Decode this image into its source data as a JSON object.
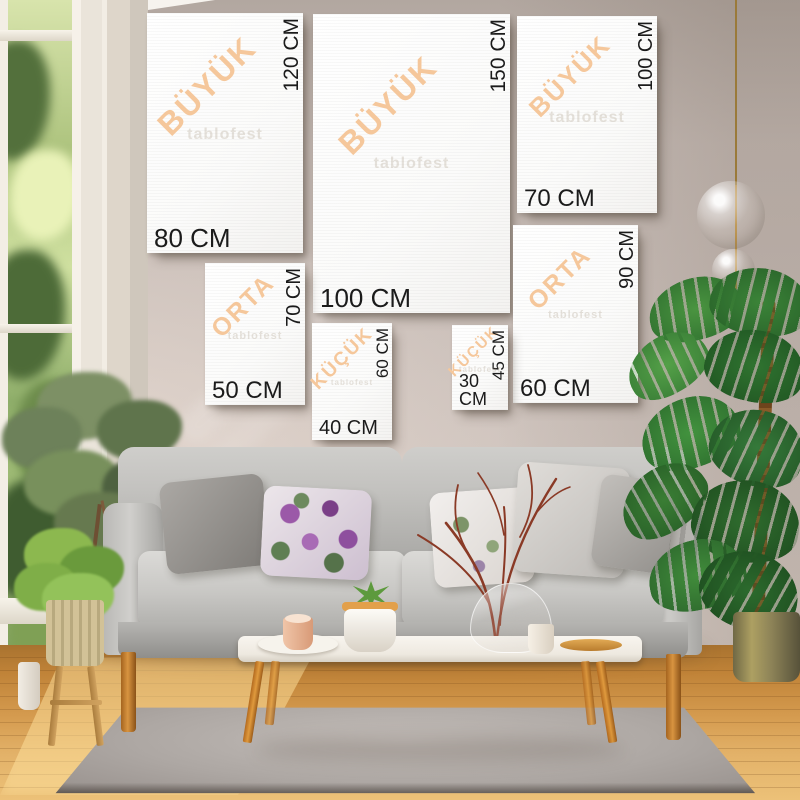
{
  "watermark": "tablofest",
  "canvases": [
    {
      "category": "BÜYÜK",
      "height_label": "120 CM",
      "width_label": "80 CM"
    },
    {
      "category": "BÜYÜK",
      "height_label": "150 CM",
      "width_label": "100 CM"
    },
    {
      "category": "BÜYÜK",
      "height_label": "100 CM",
      "width_label": "70 CM"
    },
    {
      "category": "ORTA",
      "height_label": "90 CM",
      "width_label": "60 CM"
    },
    {
      "category": "ORTA",
      "height_label": "70 CM",
      "width_label": "50 CM"
    },
    {
      "category": "KÜÇÜK",
      "height_label": "60 CM",
      "width_label": "40 CM"
    },
    {
      "category": "KÜÇÜK",
      "height_label": "45 CM",
      "width_label": "30 CM"
    }
  ],
  "colors": {
    "category_accent": "#f5c79b",
    "size_label": "#1b1b1b",
    "wall": "#c9beb9",
    "canvas": "#fbfbfa",
    "sofa": "#c6c5c2",
    "wood": "#d49a4e",
    "rug": "#ada7a3"
  }
}
